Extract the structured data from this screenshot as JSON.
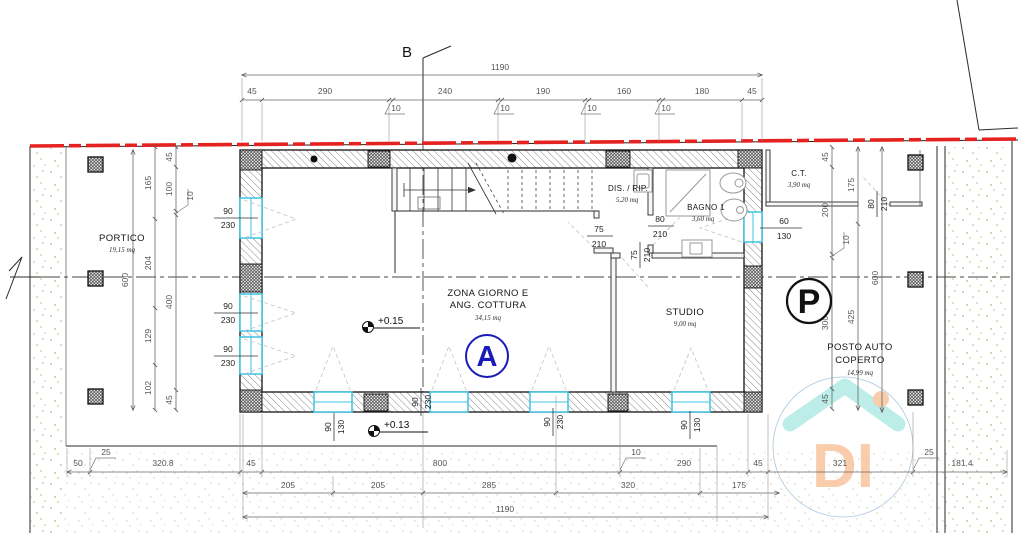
{
  "markers": {
    "section": "B",
    "unit_a": "A",
    "parking": "P",
    "level_interior": "+0.15",
    "level_exterior": "+0.13"
  },
  "rooms": {
    "portico": {
      "name": "PORTICO",
      "area": "19,15 mq"
    },
    "zona_giorno": {
      "line1": "ZONA GIORNO E",
      "line2": "ANG. COTTURA",
      "area": "34,15 mq"
    },
    "studio": {
      "name": "STUDIO",
      "area": "9,00 mq"
    },
    "dis_rip": {
      "name": "DIS. / RIP.",
      "area": "5,20 mq"
    },
    "bagno": {
      "name": "BAGNO 1",
      "area": "3,60 mq"
    },
    "ct": {
      "name": "C.T.",
      "area": "3,90 mq"
    },
    "posto_auto": {
      "line1": "POSTO AUTO",
      "line2": "COPERTO",
      "area": "14,99 mq"
    }
  },
  "dims": {
    "total": "1190",
    "top": [
      "45",
      "290",
      "240",
      "190",
      "160",
      "180",
      "45"
    ],
    "left_outer": "600",
    "left_mid": [
      "165",
      "204",
      "129",
      "102"
    ],
    "left_inner": [
      "45",
      "100",
      "400",
      "45"
    ],
    "right_inner": [
      "45",
      "200",
      "300",
      "45"
    ],
    "right_mid": [
      "175",
      "425"
    ],
    "right_outer": "600",
    "bottom_row1": [
      "50",
      "320.8",
      "45",
      "800",
      "290",
      "45",
      "321",
      "181.4"
    ],
    "bottom_row2": [
      "205",
      "205",
      "285",
      "320",
      "175"
    ],
    "flag_10": "10",
    "flag_25": "25"
  },
  "openings": {
    "w90230": {
      "w": "90",
      "h": "230"
    },
    "w90130": {
      "w": "90",
      "h": "130"
    },
    "w60130": {
      "w": "60",
      "h": "130"
    },
    "d75210": {
      "w": "75",
      "h": "210"
    },
    "d80210": {
      "w": "80",
      "h": "210"
    }
  },
  "watermark": {
    "text": "DI"
  },
  "colors": {
    "boundary_red": "#e42320",
    "window_cyan": "#3fc3e0",
    "unit_marker_blue": "#1a1ab8",
    "watermark_roof": "#b5ece6",
    "watermark_text": "#f9c7a2"
  }
}
